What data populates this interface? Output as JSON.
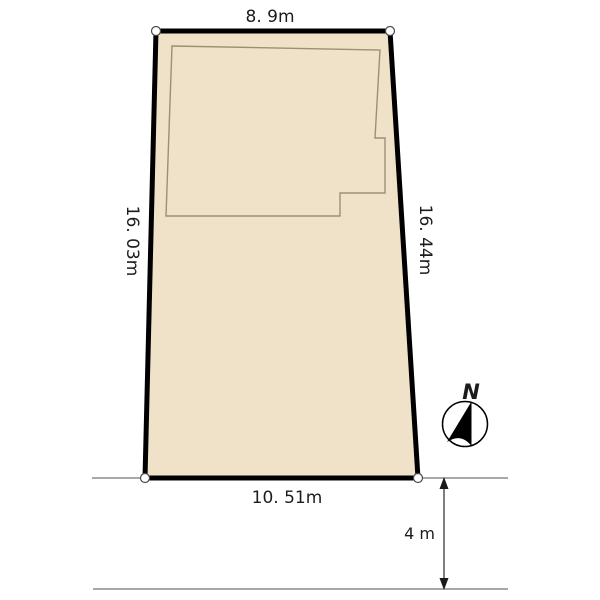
{
  "diagram": {
    "dimensions": {
      "top_edge": "8. 9m",
      "left_edge": "16. 03m",
      "right_edge": "16. 44m",
      "bottom_edge": "10. 51m",
      "road_width": "4 m"
    },
    "compass": {
      "north_label": "N"
    },
    "colors": {
      "plot_fill": "#efe2c8",
      "plot_outline": "#000000",
      "building_outline": "#9b8f76",
      "road_line": "#8c8c8c",
      "background": "#ffffff"
    }
  }
}
